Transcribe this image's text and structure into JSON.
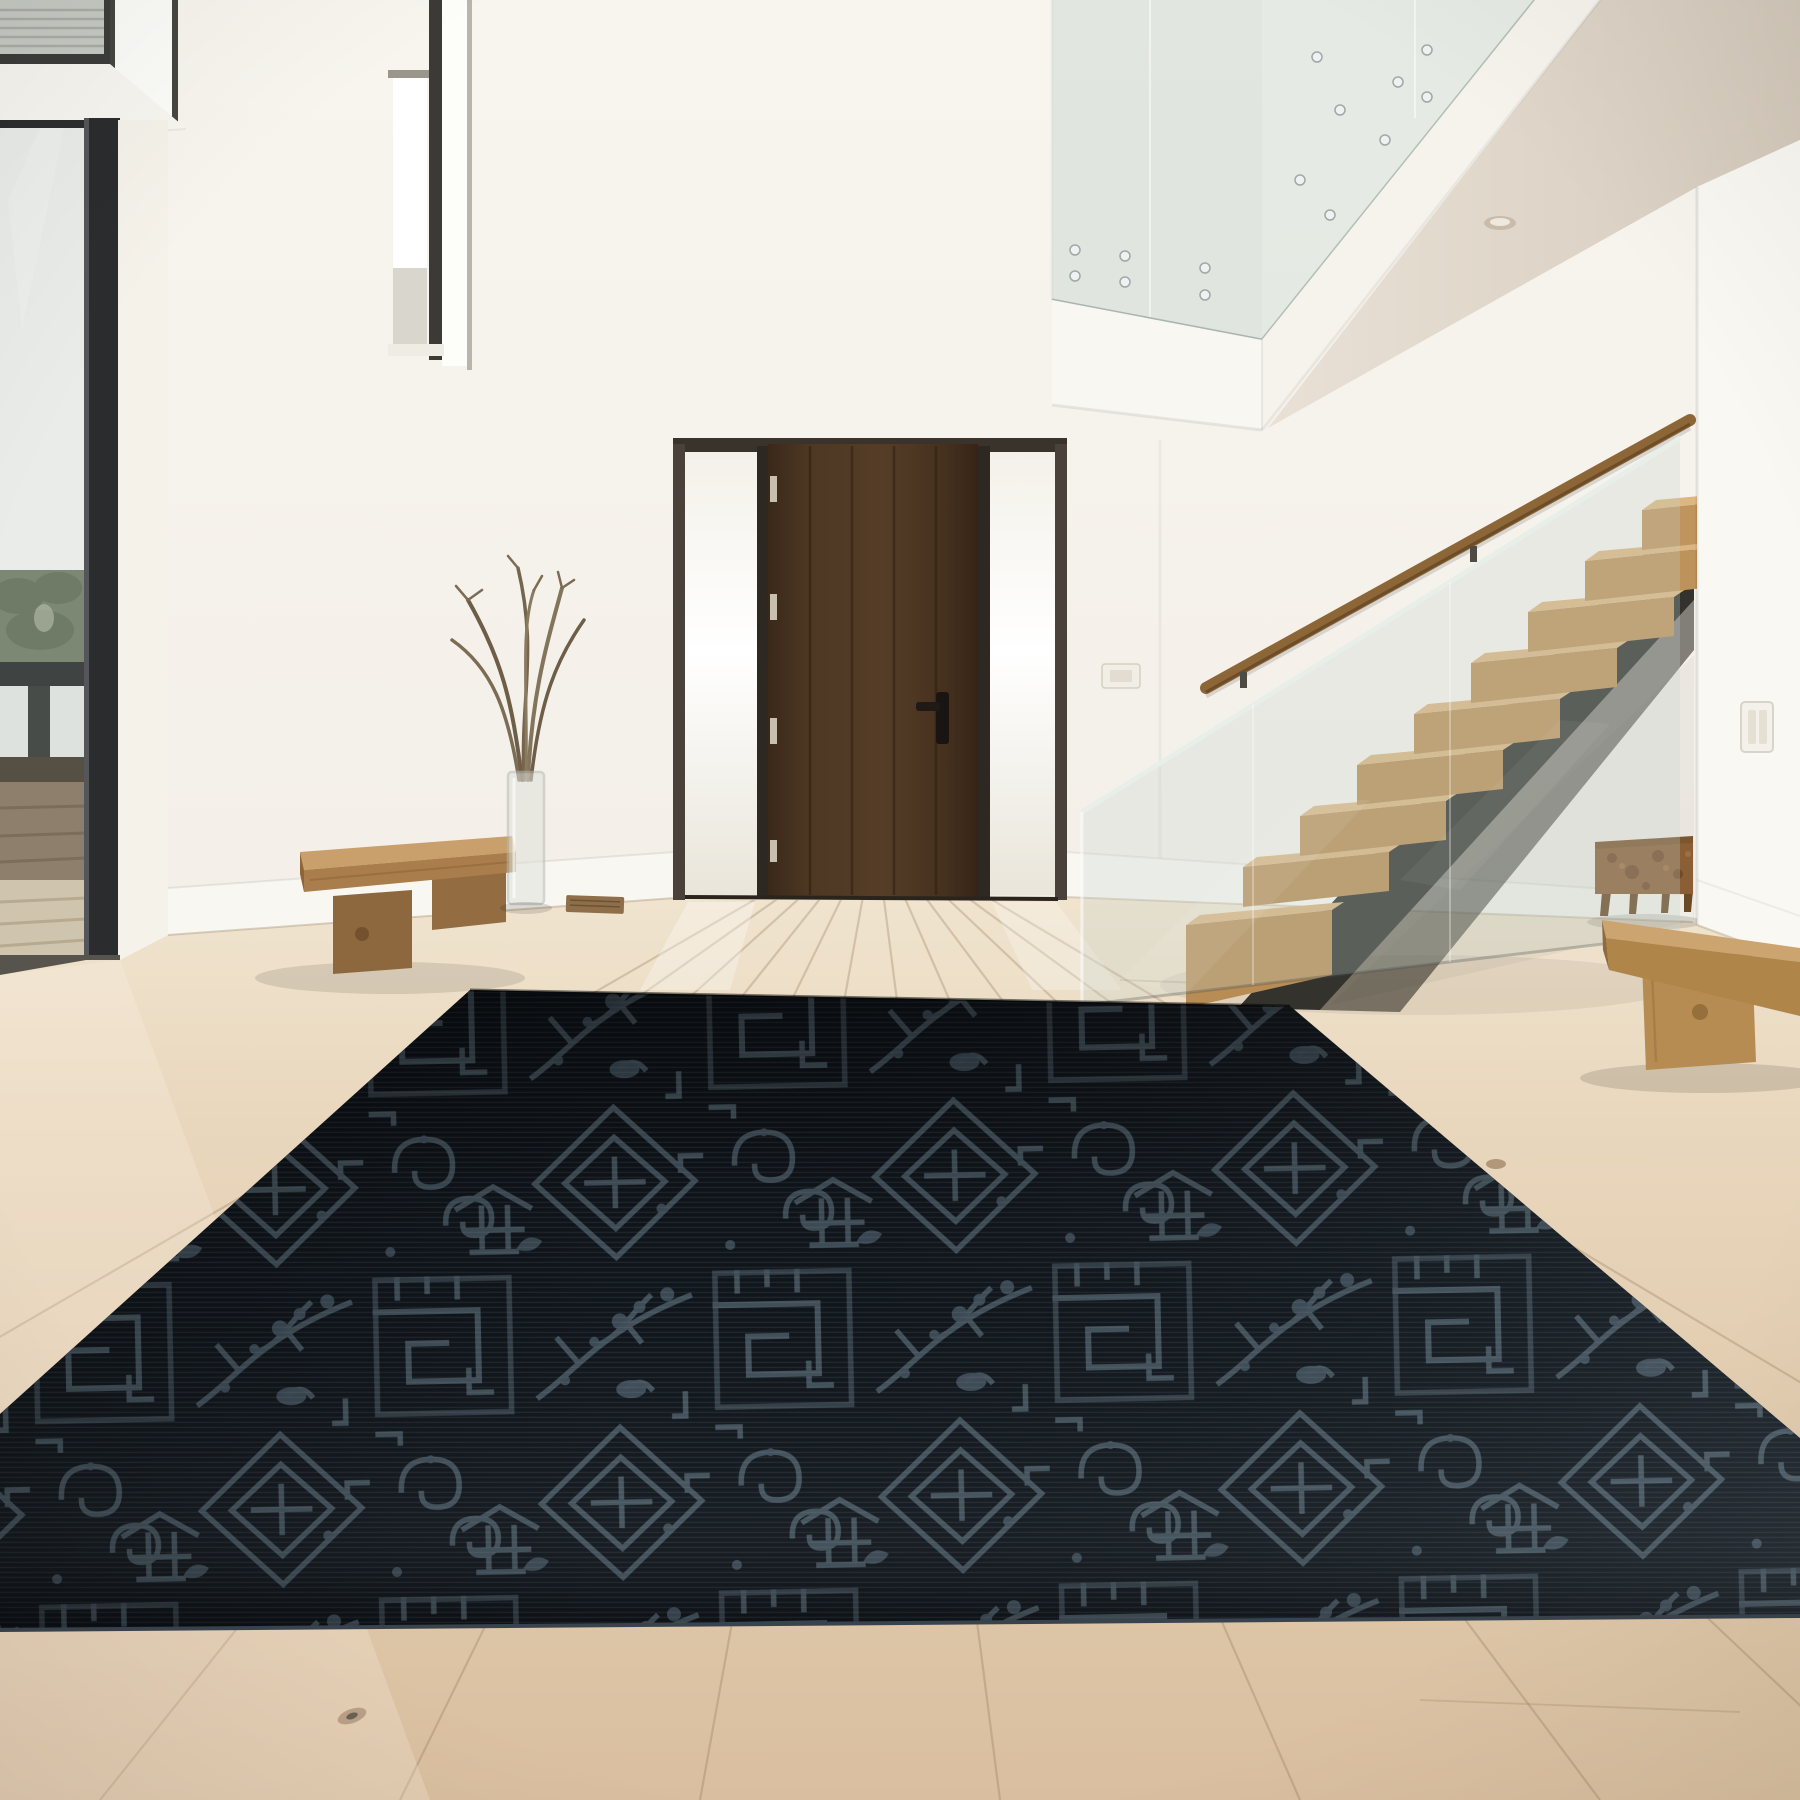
{
  "meta": {
    "title": "Modern double-height entry hall with dark chinoiserie area rug",
    "image_type": "interior photograph",
    "room": "entry hall / foyer",
    "style": "modern minimalist"
  },
  "palette": {
    "wall": "#f3efe8",
    "ceiling_soffit": "#ddd3c7",
    "floor_oak_near": "#dcc3a3",
    "floor_oak_far": "#f0e4cf",
    "rug_base": "#0e1319",
    "rug_pattern": "#4a5963",
    "door_wood": "#46301f",
    "tread_wood": "#c59a67",
    "handrail_wood": "#8d6638",
    "stringer_steel": "#33322d",
    "bench_wood": "#b68e5c",
    "console_burl": "#8a5a33",
    "window_frame": "#2e3032",
    "glass_tint": "#cdd9d3"
  },
  "scene": {
    "objects": {
      "rug": {
        "label": "dark navy chinoiserie patchwork area rug",
        "base_color": "#0e1319",
        "pattern_color": "#4a5963",
        "motifs": [
          "greek-key fretwork",
          "lattice diamonds",
          "blossom branches",
          "cloud scrolls",
          "pagodas"
        ]
      },
      "front_door": {
        "label": "dark walnut plank entry door with frosted sidelights",
        "color": "#46301f",
        "hardware": "matte black lever handle",
        "hinges": "4 visible hinges"
      },
      "floor": {
        "label": "wide-plank white oak floor",
        "color": "#e0c9ab"
      },
      "staircase": {
        "label": "floating oak staircase with glass balustrade and steel stringer",
        "tread_count_visible": 9,
        "tread_color": "#c59a67",
        "handrail": "wall-mounted oak handrail"
      },
      "mezzanine": {
        "label": "upper mezzanine with frameless glass balustrade and standoff bolts"
      },
      "left_bench": {
        "label": "solid oak slab bench",
        "color": "#b68e5c"
      },
      "right_bench": {
        "label": "solid oak slab bench",
        "color": "#bd9560"
      },
      "console": {
        "label": "burl wood console table under stairs",
        "color": "#8a5a33"
      },
      "vase": {
        "label": "clear glass vase with dry branches"
      },
      "left_window": {
        "label": "floor-to-ceiling window",
        "view": [
          "white sky",
          "green trees",
          "lake water",
          "deck railing",
          "wood deck"
        ]
      },
      "clerestory": {
        "label": "clerestory windows with shade"
      },
      "narrow_window": {
        "label": "narrow vertical slot window"
      },
      "switch_far": {
        "label": "wall keypad / switch plate"
      },
      "switch_pillar": {
        "label": "double light switch plate"
      },
      "recessed_light": {
        "label": "recessed ceiling downlight"
      },
      "floor_vent": {
        "label": "brass floor vent"
      },
      "walls": {
        "label": "white painted walls",
        "color": "#f3efe8"
      }
    }
  }
}
